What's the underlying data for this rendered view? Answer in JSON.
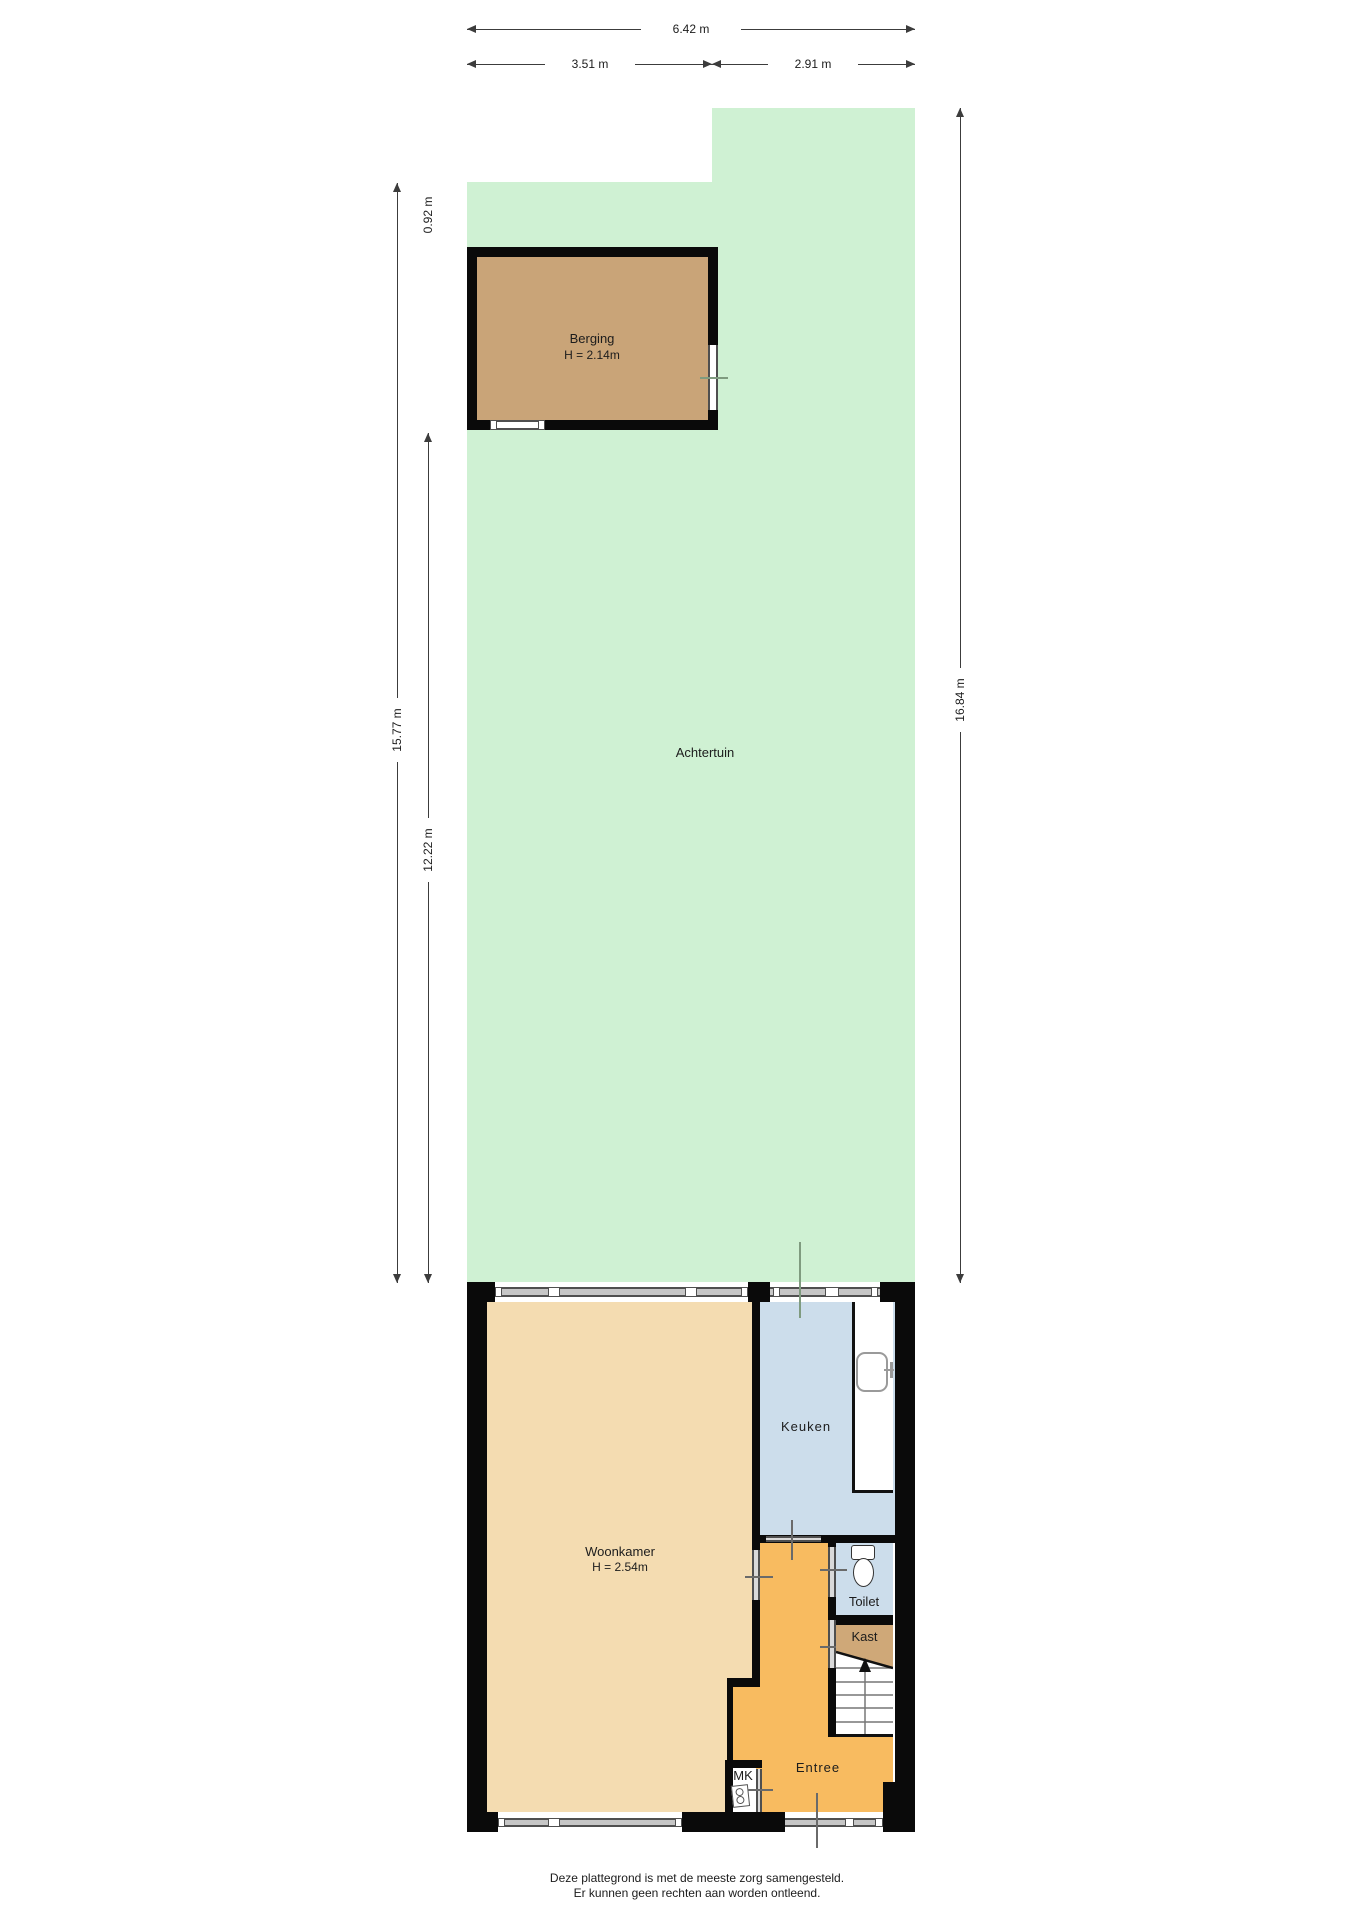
{
  "dimensions": {
    "total_width": "6.42 m",
    "width_left": "3.51 m",
    "width_right": "2.91 m",
    "garden_offset": "0.92 m",
    "garden_depth_outer": "15.77 m",
    "garden_depth_lower": "12.22 m",
    "right_depth": "16.84 m"
  },
  "rooms": {
    "achtertuin": "Achtertuin",
    "berging": {
      "name": "Berging",
      "height": "H = 2.14m"
    },
    "woonkamer": {
      "name": "Woonkamer",
      "height": "H = 2.54m"
    },
    "keuken": "Keuken",
    "toilet": "Toilet",
    "kast": "Kast",
    "entree": "Entree",
    "mk": "MK"
  },
  "disclaimer": {
    "line1": "Deze plattegrond is met de meeste zorg samengesteld.",
    "line2": "Er kunnen geen rechten aan worden ontleend."
  },
  "colors": {
    "wall": "#0a0a0a",
    "garden": "#cff1d3",
    "berging": "#c9a478",
    "woonkamer": "#f4dcb1",
    "keuken": "#ccddeb",
    "entree": "#f8bb60",
    "kast": "#cfa878",
    "strip": "#c6c6c6",
    "stripedge": "#4f4f4f",
    "dim": "#3c3c3c",
    "text": "#1c1c1c",
    "doorline": "#6a6a6a",
    "extline": "#7f9b7f"
  }
}
